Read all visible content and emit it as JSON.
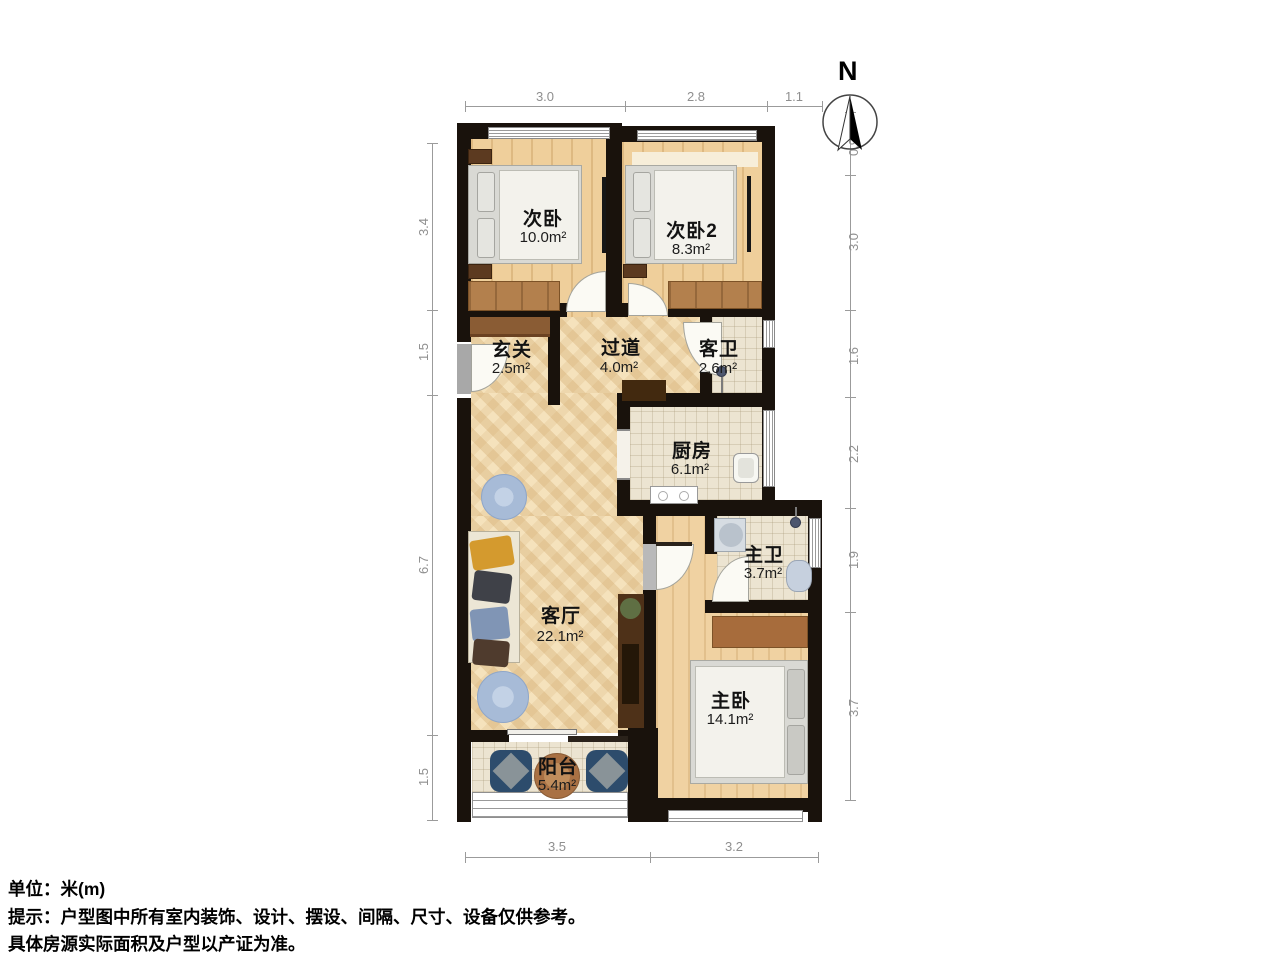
{
  "rooms": [
    {
      "name": "次卧",
      "area": "10.0m²"
    },
    {
      "name": "次卧2",
      "area": "8.3m²"
    },
    {
      "name": "玄关",
      "area": "2.5m²"
    },
    {
      "name": "过道",
      "area": "4.0m²"
    },
    {
      "name": "客卫",
      "area": "2.6m²"
    },
    {
      "name": "厨房",
      "area": "6.1m²"
    },
    {
      "name": "主卫",
      "area": "3.7m²"
    },
    {
      "name": "客厅",
      "area": "22.1m²"
    },
    {
      "name": "主卧",
      "area": "14.1m²"
    },
    {
      "name": "阳台",
      "area": "5.4m²"
    }
  ],
  "dimensions": {
    "top": [
      "3.0",
      "2.8",
      "1.1"
    ],
    "bottom": [
      "3.5",
      "3.2"
    ],
    "left": [
      "3.4",
      "1.5",
      "6.7",
      "1.5"
    ],
    "right": [
      "0.9",
      "3.0",
      "1.6",
      "2.2",
      "1.9",
      "3.7"
    ]
  },
  "compass": {
    "label": "N"
  },
  "footer": {
    "unit": "单位：米(m)",
    "tip": "提示：户型图中所有室内装饰、设计、摆设、间隔、尺寸、设备仅供参考。",
    "note": "具体房源实际面积及户型以产证为准。"
  },
  "colors": {
    "wall": "#19120c",
    "wood_plank": "#efcf9b",
    "herringbone": "#f5e2bc",
    "tile": "#ece4d1",
    "wardrobe_brown": "#b3804d",
    "balcony_chair_blue": "#2d4c6c",
    "rug_blue": "#a7bbd7",
    "dim_gray": "#8f8f8f"
  }
}
